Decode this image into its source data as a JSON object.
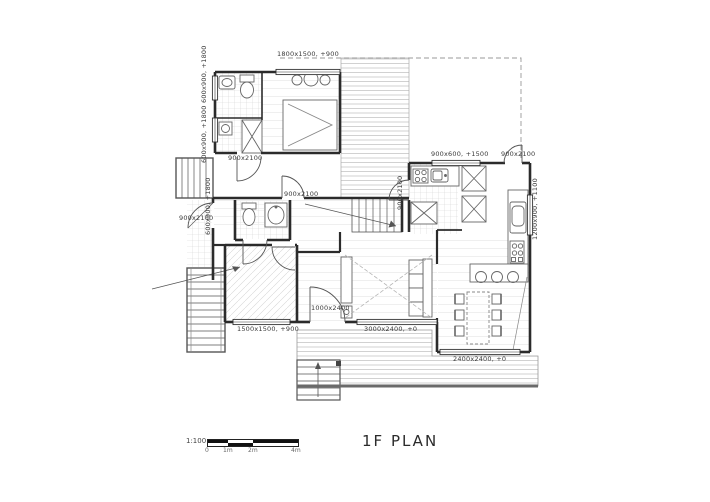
{
  "title": "1F PLAN",
  "scale_bar": {
    "ratio": "1:100",
    "ticks": [
      "0",
      "1m",
      "2m",
      "4m"
    ]
  },
  "labels": {
    "win_bed_top": "1800x1500, +900",
    "win_bath_upper": "600x900, +1800",
    "win_bath_lower": "600x900, +1800",
    "door_bedroom": "900x2100",
    "door_entry": "900x2100",
    "win_wc": "600x900, +1800",
    "door_hall": "900x2100",
    "win_kitchen": "900x600, +1500",
    "door_kitchen": "900x2100",
    "door_deck": "900x2100",
    "win_dining_right": "1200x900, +1100",
    "door_living": "1000x2400",
    "win_room2": "1500x1500, +900",
    "win_living": "3000x2400, +0",
    "win_dining_bottom": "2400x2400, +0"
  },
  "colors": {
    "wall": "#2b2b2b",
    "line": "#555555",
    "hatch": "#cccccc",
    "text": "#3a3a3a"
  }
}
